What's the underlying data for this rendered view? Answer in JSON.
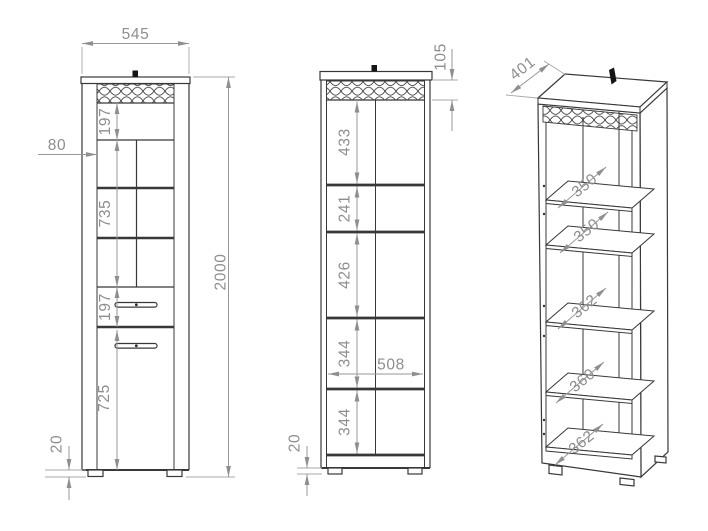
{
  "drawing": {
    "type": "furniture technical drawing - tall display cabinet",
    "background": "#ffffff",
    "line_color": "#383838",
    "dim_color": "#8e8e8e",
    "front_view": {
      "name": "front view with doors",
      "dims": {
        "overall_width": "545",
        "overall_height": "2000",
        "top_section_height": "197",
        "side_stile_width": "80",
        "glass_section_height": "735",
        "drawer_height": "197",
        "door_height": "725",
        "foot_height": "20"
      }
    },
    "internal_view": {
      "name": "front view internal sections",
      "dims": {
        "top_panel_height": "105",
        "section_1": "433",
        "section_2": "241",
        "section_3": "426",
        "section_4": "344",
        "inner_width": "508",
        "section_5": "344",
        "foot_height": "20"
      }
    },
    "isometric_view": {
      "name": "isometric view open carcass",
      "dims": {
        "depth": "401",
        "shelf_1_depth": "350",
        "shelf_2_depth": "350",
        "shelf_3_depth": "362",
        "shelf_4_depth": "360",
        "bottom_depth": "362"
      }
    }
  }
}
